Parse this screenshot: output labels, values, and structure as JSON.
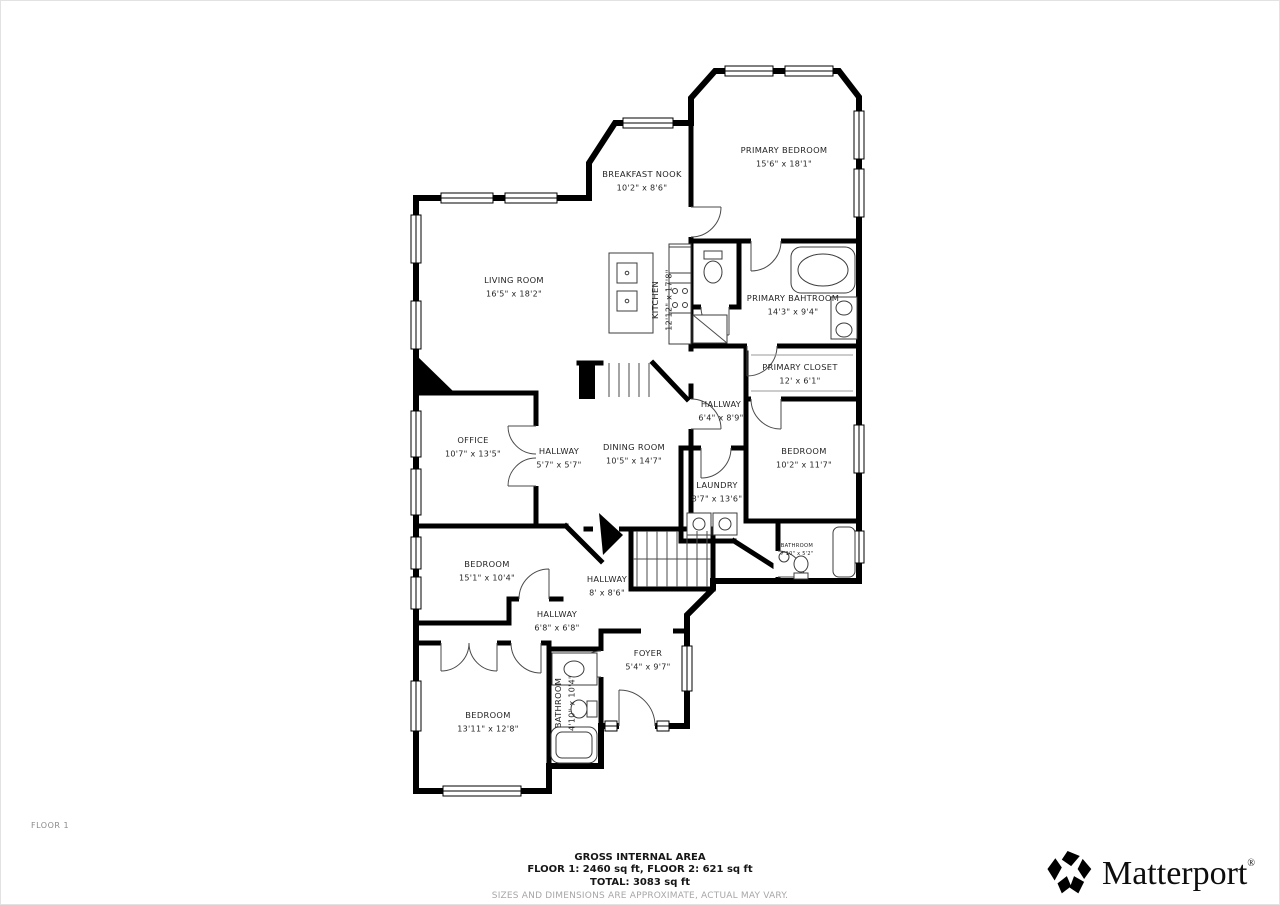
{
  "floor_label": "FLOOR 1",
  "rooms": [
    {
      "name": "PRIMARY BEDROOM",
      "dims": "15'6\" x 18'1\"",
      "x": 783,
      "y": 152
    },
    {
      "name": "BREAKFAST NOOK",
      "dims": "10'2\" x 8'6\"",
      "x": 641,
      "y": 176
    },
    {
      "name": "LIVING ROOM",
      "dims": "16'5\" x 18'2\"",
      "x": 513,
      "y": 282
    },
    {
      "name": "KITCHEN",
      "dims": "12'12\" x 17'8\"",
      "x": 657,
      "y": 299,
      "rotated": true
    },
    {
      "name": "PRIMARY BAHTROOM",
      "dims": "14'3\" x 9'4\"",
      "x": 792,
      "y": 300
    },
    {
      "name": "PRIMARY CLOSET",
      "dims": "12' x 6'1\"",
      "x": 799,
      "y": 369
    },
    {
      "name": "HALLWAY",
      "dims": "6'4\" x 8'9\"",
      "x": 720,
      "y": 406
    },
    {
      "name": "DINING ROOM",
      "dims": "10'5\" x 14'7\"",
      "x": 633,
      "y": 449
    },
    {
      "name": "OFFICE",
      "dims": "10'7\" x 13'5\"",
      "x": 472,
      "y": 442
    },
    {
      "name": "HALLWAY",
      "dims": "5'7\" x 5'7\"",
      "x": 558,
      "y": 453
    },
    {
      "name": "BEDROOM",
      "dims": "10'2\" x 11'7\"",
      "x": 803,
      "y": 453
    },
    {
      "name": "LAUNDRY",
      "dims": "8'7\" x 13'6\"",
      "x": 716,
      "y": 487
    },
    {
      "name": "BATHROOM",
      "dims": "7'10\" x 5'2\"",
      "x": 796,
      "y": 546,
      "small": true
    },
    {
      "name": "BEDROOM",
      "dims": "15'1\" x 10'4\"",
      "x": 486,
      "y": 566
    },
    {
      "name": "HALLWAY",
      "dims": "8' x 8'6\"",
      "x": 606,
      "y": 581
    },
    {
      "name": "HALLWAY",
      "dims": "6'8\" x 6'8\"",
      "x": 556,
      "y": 616
    },
    {
      "name": "FOYER",
      "dims": "5'4\" x 9'7\"",
      "x": 647,
      "y": 655
    },
    {
      "name": "BATHROOM",
      "dims": "4'10\" x 10'4\"",
      "x": 560,
      "y": 702,
      "rotated": true
    },
    {
      "name": "BEDROOM",
      "dims": "13'11\" x 12'8\"",
      "x": 487,
      "y": 717
    }
  ],
  "footer": {
    "title": "GROSS INTERNAL AREA",
    "floors_line": "FLOOR 1: 2460 sq ft, FLOOR 2: 621 sq ft",
    "total_line": "TOTAL: 3083 sq ft",
    "disclaimer": "SIZES AND DIMENSIONS ARE APPROXIMATE, ACTUAL MAY VARY."
  },
  "branding": {
    "wordmark": "Matterport",
    "registered": "®",
    "logo_icon": "matterport-logo"
  }
}
